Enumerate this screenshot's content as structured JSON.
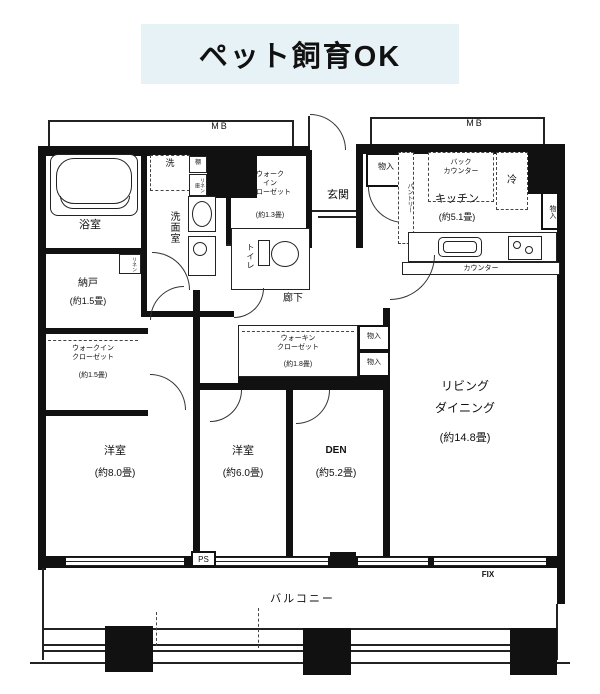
{
  "banner": {
    "text": "ペット飼育OK"
  },
  "floorplan": {
    "meter_box_left": "MB",
    "meter_box_right": "MB",
    "rooms": {
      "bath": {
        "name": "浴室"
      },
      "washroom": {
        "name": "洗面室"
      },
      "toilet": {
        "name": "トイレ"
      },
      "entrance": {
        "name": "玄関"
      },
      "hallway": {
        "name": "廊下"
      },
      "storage": {
        "name": "納戸",
        "size": "(約1.5畳)"
      },
      "wic_entrance": {
        "name": "ウォーク\nイン\nクローゼット",
        "size": "(約1.3畳)"
      },
      "wic_west": {
        "name": "ウォークイン\nクローゼット",
        "size": "(約1.5畳)"
      },
      "wic_center": {
        "name": "ウォーキン\nクローゼット",
        "size": "(約1.8畳)"
      },
      "kitchen": {
        "name": "キッチン",
        "size": "(約5.1畳)"
      },
      "living_dining": {
        "name": "リビング\nダイニング",
        "size": "(約14.8畳)"
      },
      "bedroom_west": {
        "name": "洋室",
        "size": "(約8.0畳)"
      },
      "bedroom_center": {
        "name": "洋室",
        "size": "(約6.0畳)"
      },
      "den": {
        "name": "DEN",
        "size": "(約5.2畳)"
      },
      "balcony": {
        "name": "バルコニー"
      }
    },
    "fixtures": {
      "washer": "洗",
      "shelf": "棚",
      "linen_washroom": "リネン庫",
      "linen_storage": "リネン",
      "pantry": "パントリー",
      "back_counter": "バック\nカウンター",
      "fridge": "冷",
      "counter": "カウンター"
    },
    "closets": {
      "entrance_side": "物入",
      "kitchen_side": "物入",
      "center_upper": "物入",
      "center_lower": "物入"
    },
    "marks": {
      "ps": "PS",
      "fix": "FIX"
    }
  }
}
